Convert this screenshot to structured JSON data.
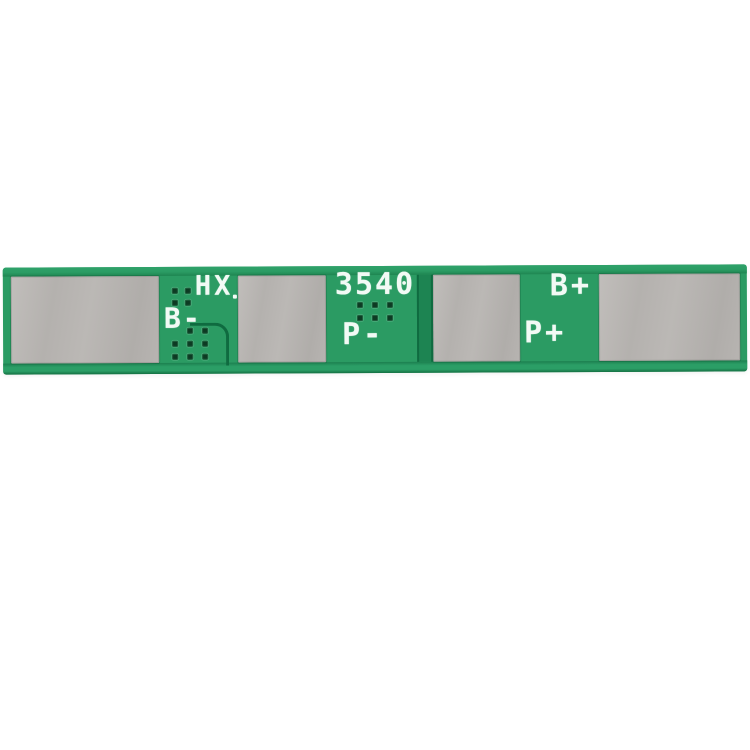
{
  "labels": {
    "chip_mark": "HX",
    "b_minus": "B-",
    "model": "3540",
    "p_minus": "P-",
    "b_plus": "B+",
    "p_plus": "P+"
  },
  "colors": {
    "board_green": "#2b9b63",
    "board_edge_dark": "#1c7f4f",
    "trace_dark": "#0f6b40",
    "divider_green": "#1d8452",
    "pad_silver": "#b7b4b1",
    "via_dark": "#0d3a23",
    "silkscreen": "#f2faf5",
    "background": "#ffffff"
  },
  "vias": {
    "groups": [
      {
        "name": "upper-left-grid",
        "left": 169,
        "top": 21,
        "cols": 2,
        "rows": 2,
        "stepX": 13,
        "stepY": 12,
        "skip": []
      },
      {
        "name": "lower-left-grid",
        "left": 169,
        "top": 61,
        "cols": 3,
        "rows": 3,
        "stepX": 15,
        "stepY": 13,
        "skip": [
          [
            0,
            0
          ]
        ]
      },
      {
        "name": "center-grid",
        "left": 354,
        "top": 36,
        "cols": 3,
        "rows": 2,
        "stepX": 15,
        "stepY": 13,
        "skip": []
      }
    ]
  }
}
